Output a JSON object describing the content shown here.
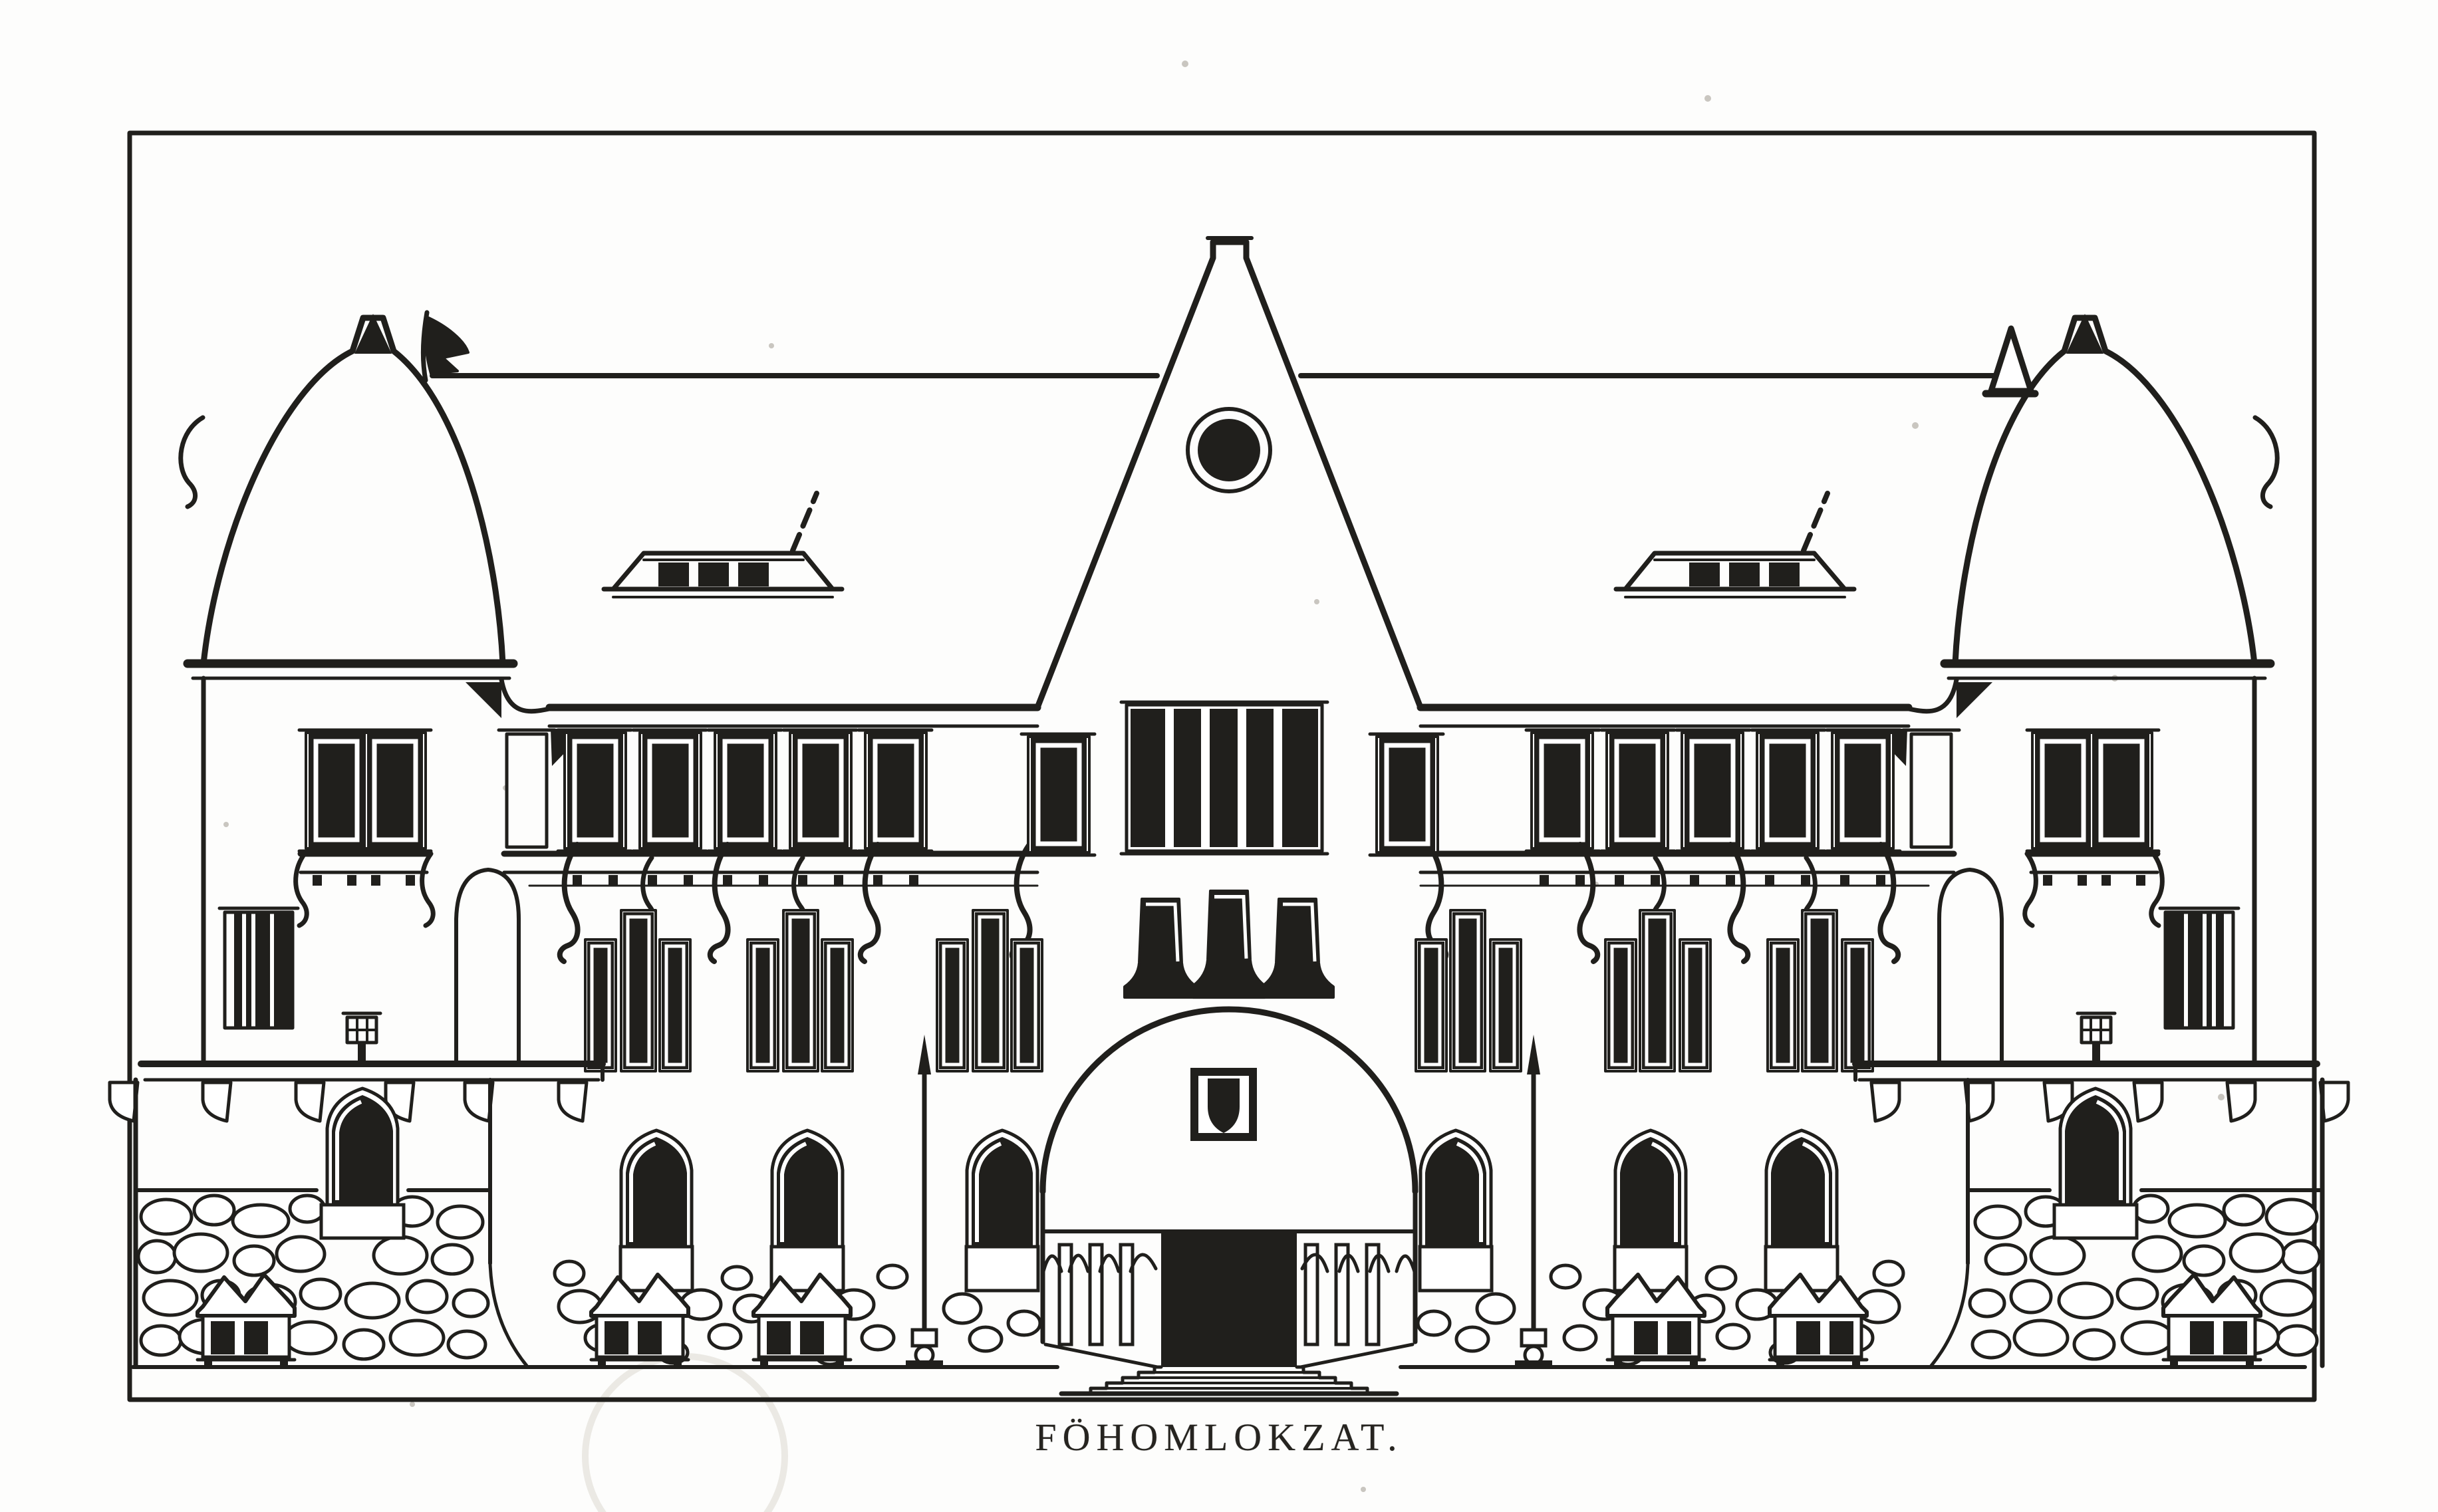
{
  "figure": {
    "caption": "FÖHOMLOKZAT.",
    "kind": "architectural facade elevation line drawing"
  },
  "colors": {
    "paper": "#fdfdfc",
    "ink": "#201f1c",
    "speck": "#c9c6c0",
    "watermark": "#ebe9e4"
  }
}
